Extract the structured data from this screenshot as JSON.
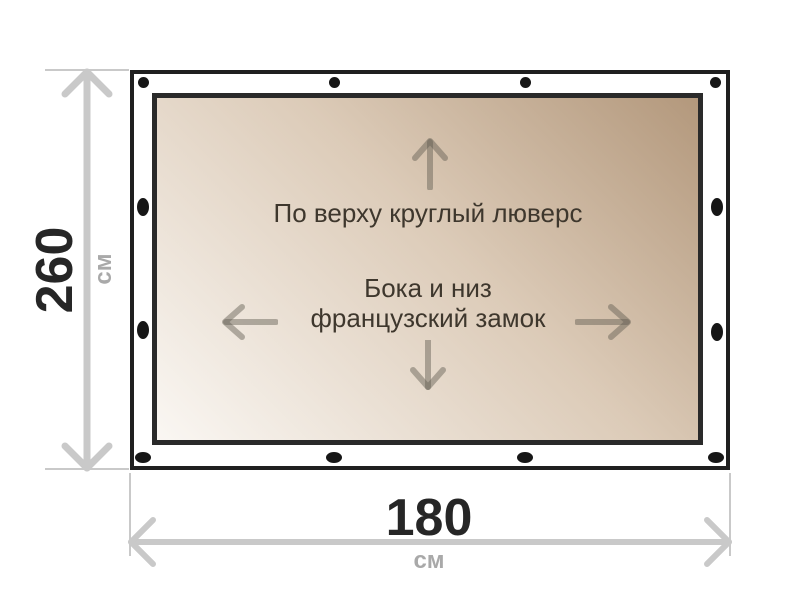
{
  "diagram": {
    "type": "product-dimension-diagram",
    "labels": {
      "top_edge": "По верху круглый люверс",
      "middle_line1": "Бока и низ",
      "middle_line2": "французский замок"
    },
    "dimensions": {
      "height": {
        "value": "260",
        "unit": "см"
      },
      "width": {
        "value": "180",
        "unit": "см"
      }
    },
    "grommets": {
      "top": 4,
      "bottom": 4,
      "left": 2,
      "right": 2
    },
    "direction_arrows": [
      "up",
      "left",
      "right",
      "down"
    ],
    "colors": {
      "fabric_start": "#faf7f3",
      "fabric_end": "#b3987c",
      "frame_border": "#1f1f1f",
      "inner_border": "#2a2a2a",
      "grommet": "#161616",
      "dimension_line": "#c9c9c9",
      "dimension_value": "#262626",
      "dimension_unit": "#a9a9a9",
      "label_text": "#3e372d",
      "direction_arrow": "rgba(95,90,80,0.45)"
    }
  }
}
